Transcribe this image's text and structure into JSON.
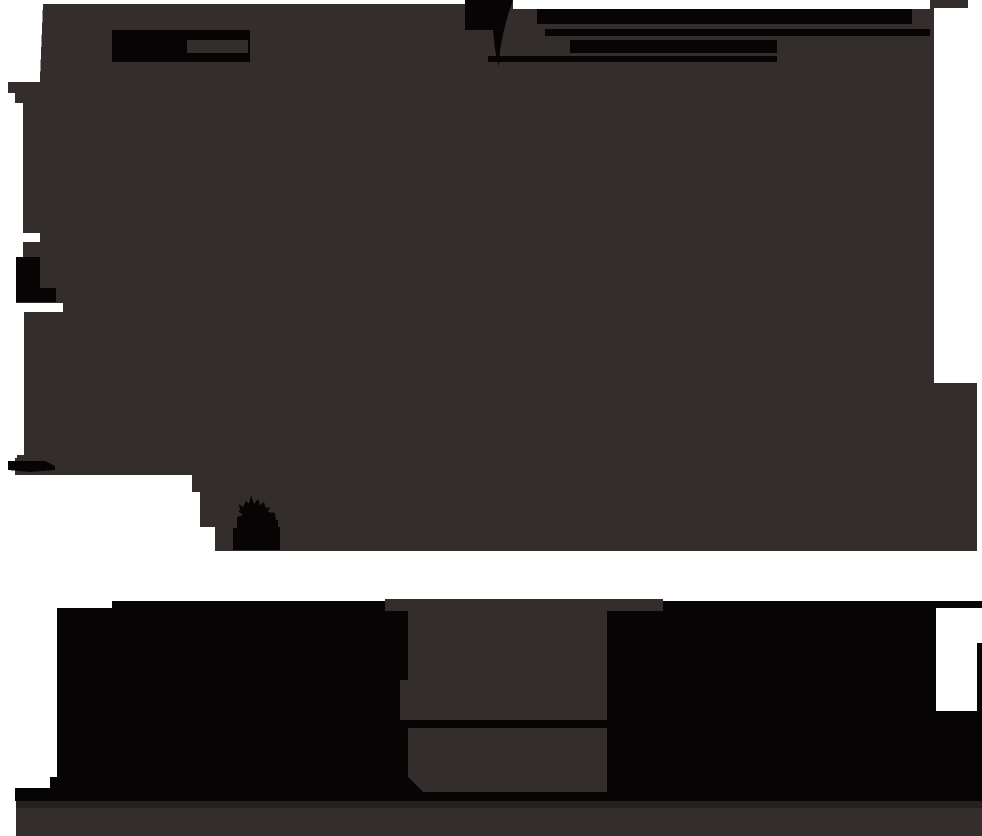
{
  "scene": {
    "type": "underexposed-dark-photograph",
    "has_text": false,
    "canvas": {
      "width": 982,
      "height": 836
    },
    "palette": {
      "white": "#ffffff",
      "mass": "#332d2c",
      "black": "#060404",
      "band": "#262121"
    },
    "shapes": [
      {
        "name": "dark-mass",
        "fill": "mass",
        "type": "polygon",
        "points": "43,4 465,4 465,0 513,0 513,9 930,9 930,0 968,0 968,8 934,8 934,383 977,383 977,551 215,551 215,527 200,527 200,492 192,492 192,475 15,475 15,458 17,458 17,455 24,455 24,312 63,312 63,303 16,303 16,257 23,257 23,242 40,242 40,233 23,233 23,103 15,103 15,93 8,93 8,82 40,82 40,78"
      },
      {
        "name": "device-block",
        "fill": "black",
        "type": "rect",
        "x": 112,
        "y": 30,
        "w": 138,
        "h": 32
      },
      {
        "name": "device-slot",
        "fill": "mass",
        "type": "rect",
        "x": 187,
        "y": 40,
        "w": 61,
        "h": 13
      },
      {
        "name": "top-block",
        "fill": "black",
        "type": "polygon",
        "points": "465,0 513,0 508,15 504,30 465,30"
      },
      {
        "name": "top-streak",
        "fill": "black",
        "type": "polygon",
        "points": "493,30 504,30 500,50 499,67 495,50"
      },
      {
        "name": "bar-a",
        "fill": "black",
        "type": "rect",
        "x": 537,
        "y": 9,
        "w": 375,
        "h": 15
      },
      {
        "name": "bar-b",
        "fill": "black",
        "type": "rect",
        "x": 545,
        "y": 29,
        "w": 385,
        "h": 7
      },
      {
        "name": "bar-c",
        "fill": "black",
        "type": "rect",
        "x": 570,
        "y": 40,
        "w": 207,
        "h": 13
      },
      {
        "name": "bar-d",
        "fill": "black",
        "type": "rect",
        "x": 488,
        "y": 56,
        "w": 289,
        "h": 6
      },
      {
        "name": "edge-block",
        "fill": "black",
        "type": "polygon",
        "points": "16,257 40,257 40,288 56,288 56,302 16,302"
      },
      {
        "name": "corner-bits",
        "fill": "black",
        "type": "polygon",
        "points": "8,461 45,461 55,466 55,470 30,472 8,470"
      },
      {
        "name": "plant-silhouette",
        "fill": "black",
        "type": "polygon",
        "points": "240,510 239,504 243,507 246,501 249,504 251,495 254,504 258,499 260,505 264,502 266,508 270,507 268,512 275,513 276,520 278,520 278,527 280,527 280,550 233,550 233,528 237,528 237,517 243,515 238,511"
      },
      {
        "name": "bottom-mass",
        "fill": "black",
        "type": "polygon",
        "points": "57,608 112,608 112,601 982,601 982,801 15,801 15,788 50,788 50,777 57,777"
      },
      {
        "name": "stand-top",
        "fill": "mass",
        "type": "rect",
        "x": 385,
        "y": 599,
        "w": 278,
        "h": 12
      },
      {
        "name": "stand-body",
        "fill": "mass",
        "type": "polygon",
        "points": "408,611 607,611 607,720 400,720 400,680 408,680"
      },
      {
        "name": "stand-base",
        "fill": "mass",
        "type": "polygon",
        "points": "408,728 607,728 607,792 423,792 408,777"
      },
      {
        "name": "white-notch",
        "fill": "white",
        "type": "polygon",
        "points": "936,608 982,608 982,643 977,643 977,711 936,711"
      },
      {
        "name": "floor-band",
        "fill": "band",
        "type": "rect",
        "x": 16,
        "y": 801,
        "w": 966,
        "h": 7
      },
      {
        "name": "floor",
        "fill": "mass",
        "type": "rect",
        "x": 16,
        "y": 808,
        "w": 966,
        "h": 28
      }
    ]
  }
}
